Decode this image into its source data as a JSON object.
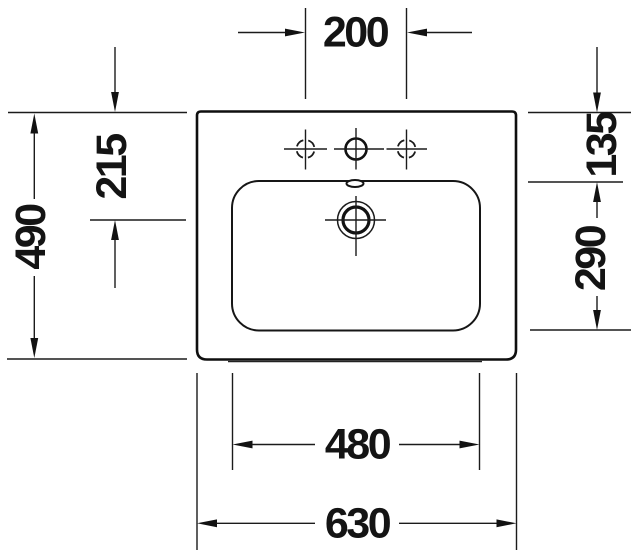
{
  "drawing": {
    "type": "washbasin-plan-view-technical-drawing",
    "background_color": "#ffffff",
    "line_color": "#1b1b1b",
    "text_color": "#141414"
  },
  "symbols": {
    "drain": "concentric-circles-with-crosshair",
    "tap_hole_center": "solid-circle-with-crosshair",
    "tap_hole_optional": "dashed-circle-with-crosshair",
    "overflow": "small-ellipse-on-basin-rim"
  },
  "dimensions": {
    "tap_hole_spacing": {
      "value": "200",
      "orientation": "horizontal",
      "position": "top"
    },
    "overall_depth": {
      "value": "490",
      "orientation": "vertical",
      "position": "far-left"
    },
    "edge_to_drain": {
      "value": "215",
      "orientation": "vertical",
      "position": "left"
    },
    "edge_to_basin": {
      "value": "135",
      "orientation": "vertical",
      "position": "right-top"
    },
    "basin_depth": {
      "value": "290",
      "orientation": "vertical",
      "position": "right"
    },
    "basin_width": {
      "value": "480",
      "orientation": "horizontal",
      "position": "bottom-inner"
    },
    "overall_width": {
      "value": "630",
      "orientation": "horizontal",
      "position": "bottom-outer"
    }
  }
}
